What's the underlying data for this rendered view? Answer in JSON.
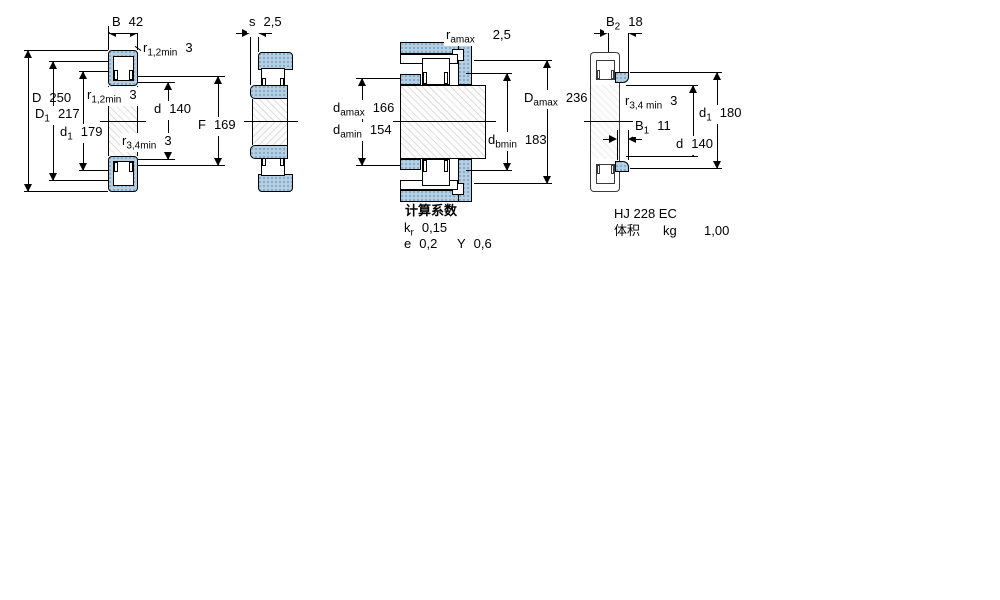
{
  "drawing": {
    "type": "bearing-dimension-drawing"
  },
  "dims": {
    "v1B": {
      "sym": "B",
      "val": "42"
    },
    "v1D": {
      "sym": "D",
      "val": "250"
    },
    "v1D1": {
      "sym": "D",
      "sub": "1",
      "val": "217"
    },
    "v1d1": {
      "sym": "d",
      "sub": "1",
      "val": "179"
    },
    "v1r12a": {
      "sym": "r",
      "sub": "1,2min",
      "val": "3"
    },
    "v1r12b": {
      "sym": "r",
      "sub": "1,2min",
      "val": "3"
    },
    "v1r34": {
      "sym": "r",
      "sub": "3,4min",
      "val": "3"
    },
    "v1d": {
      "sym": "d",
      "val": "140"
    },
    "v1F": {
      "sym": "F",
      "val": "169"
    },
    "v2s": {
      "sym": "s",
      "val": "2,5"
    },
    "v3ra": {
      "sym": "r",
      "sub": "amax",
      "val": "2,5"
    },
    "v3damax": {
      "sym": "d",
      "sub": "amax",
      "val": "166"
    },
    "v3damin": {
      "sym": "d",
      "sub": "amin",
      "val": "154"
    },
    "v3Damax": {
      "sym": "D",
      "sub": "amax",
      "val": "236"
    },
    "v3dbmin": {
      "sym": "d",
      "sub": "bmin",
      "val": "183"
    },
    "v4B2": {
      "sym": "B",
      "sub": "2",
      "val": "18"
    },
    "v4r34": {
      "sym": "r",
      "sub": "3,4 min",
      "val": "3"
    },
    "v4B1": {
      "sym": "B",
      "sub": "1",
      "val": "11"
    },
    "v4d": {
      "sym": "d",
      "val": "140"
    },
    "v4d1": {
      "sym": "d",
      "sub": "1",
      "val": "180"
    }
  },
  "calc": {
    "title": "计算系数",
    "kr": {
      "sym": "k",
      "sub": "r",
      "val": "0,15"
    },
    "e": {
      "sym": "e",
      "val": "0,2"
    },
    "Y": {
      "sym": "Y",
      "val": "0,6"
    }
  },
  "hj": {
    "designation": "HJ 228 EC",
    "mass_label": "体积",
    "mass_unit": "kg",
    "mass_value": "1,00"
  },
  "colors": {
    "steel_blue": "#b5cfe2",
    "stipple_dot": "#7aa3c4",
    "line": "#000000"
  }
}
